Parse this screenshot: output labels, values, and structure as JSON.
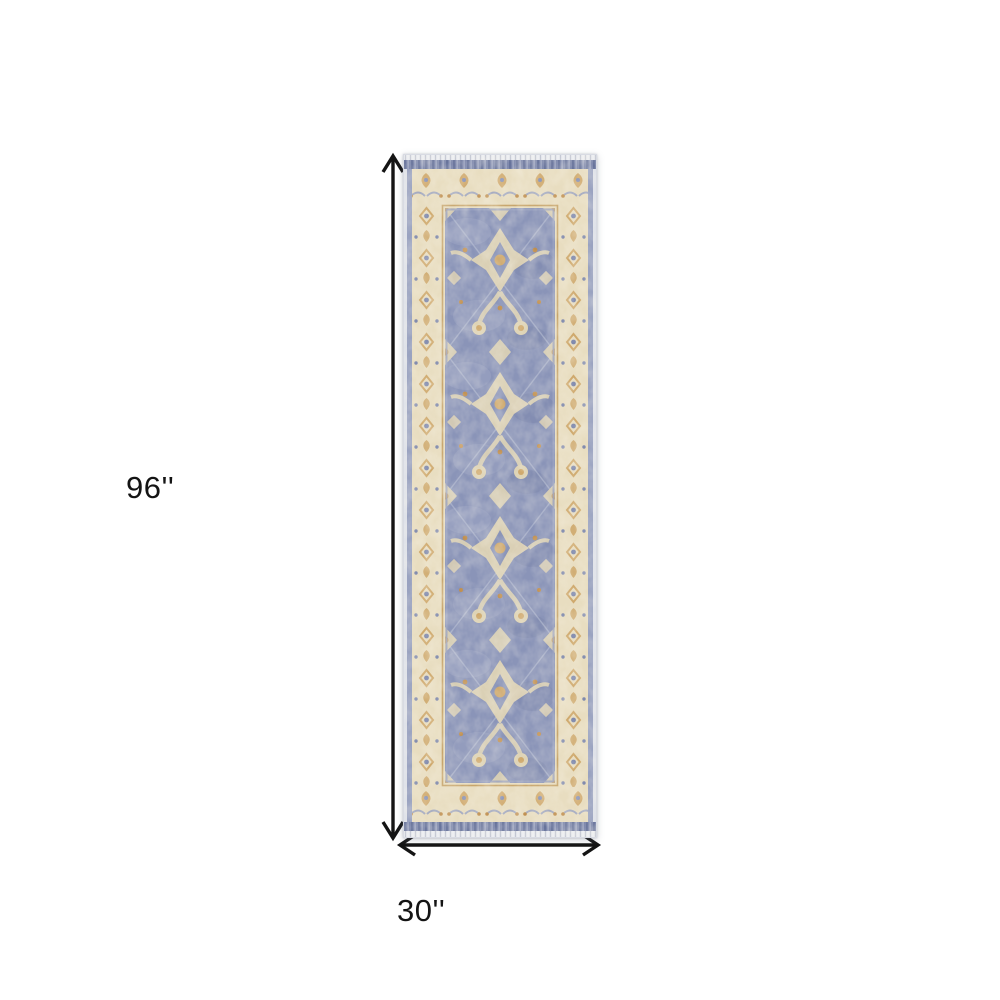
{
  "page": {
    "background_color": "#ffffff"
  },
  "figure": {
    "type": "product-dimensions",
    "height_label": "96''",
    "width_label": "30''"
  },
  "rug": {
    "name": "vintage-runner-rug",
    "orientation": "vertical-runner",
    "style": "distressed traditional oriental runner with cream border and blue field",
    "colors": {
      "field_blue": "#8a94b8",
      "field_blue_light": "#9da6c4",
      "field_blue_dark": "#7b85ab",
      "border_cream": "#e8ddc0",
      "motif_cream": "#ded3b5",
      "accent_gold": "#cfa96d",
      "accent_gold_dark": "#c08f4f",
      "edge_blue": "#7f89ad",
      "edge_blue_dark": "#67739b"
    }
  },
  "annotations": {
    "arrow_color": "#141414"
  }
}
